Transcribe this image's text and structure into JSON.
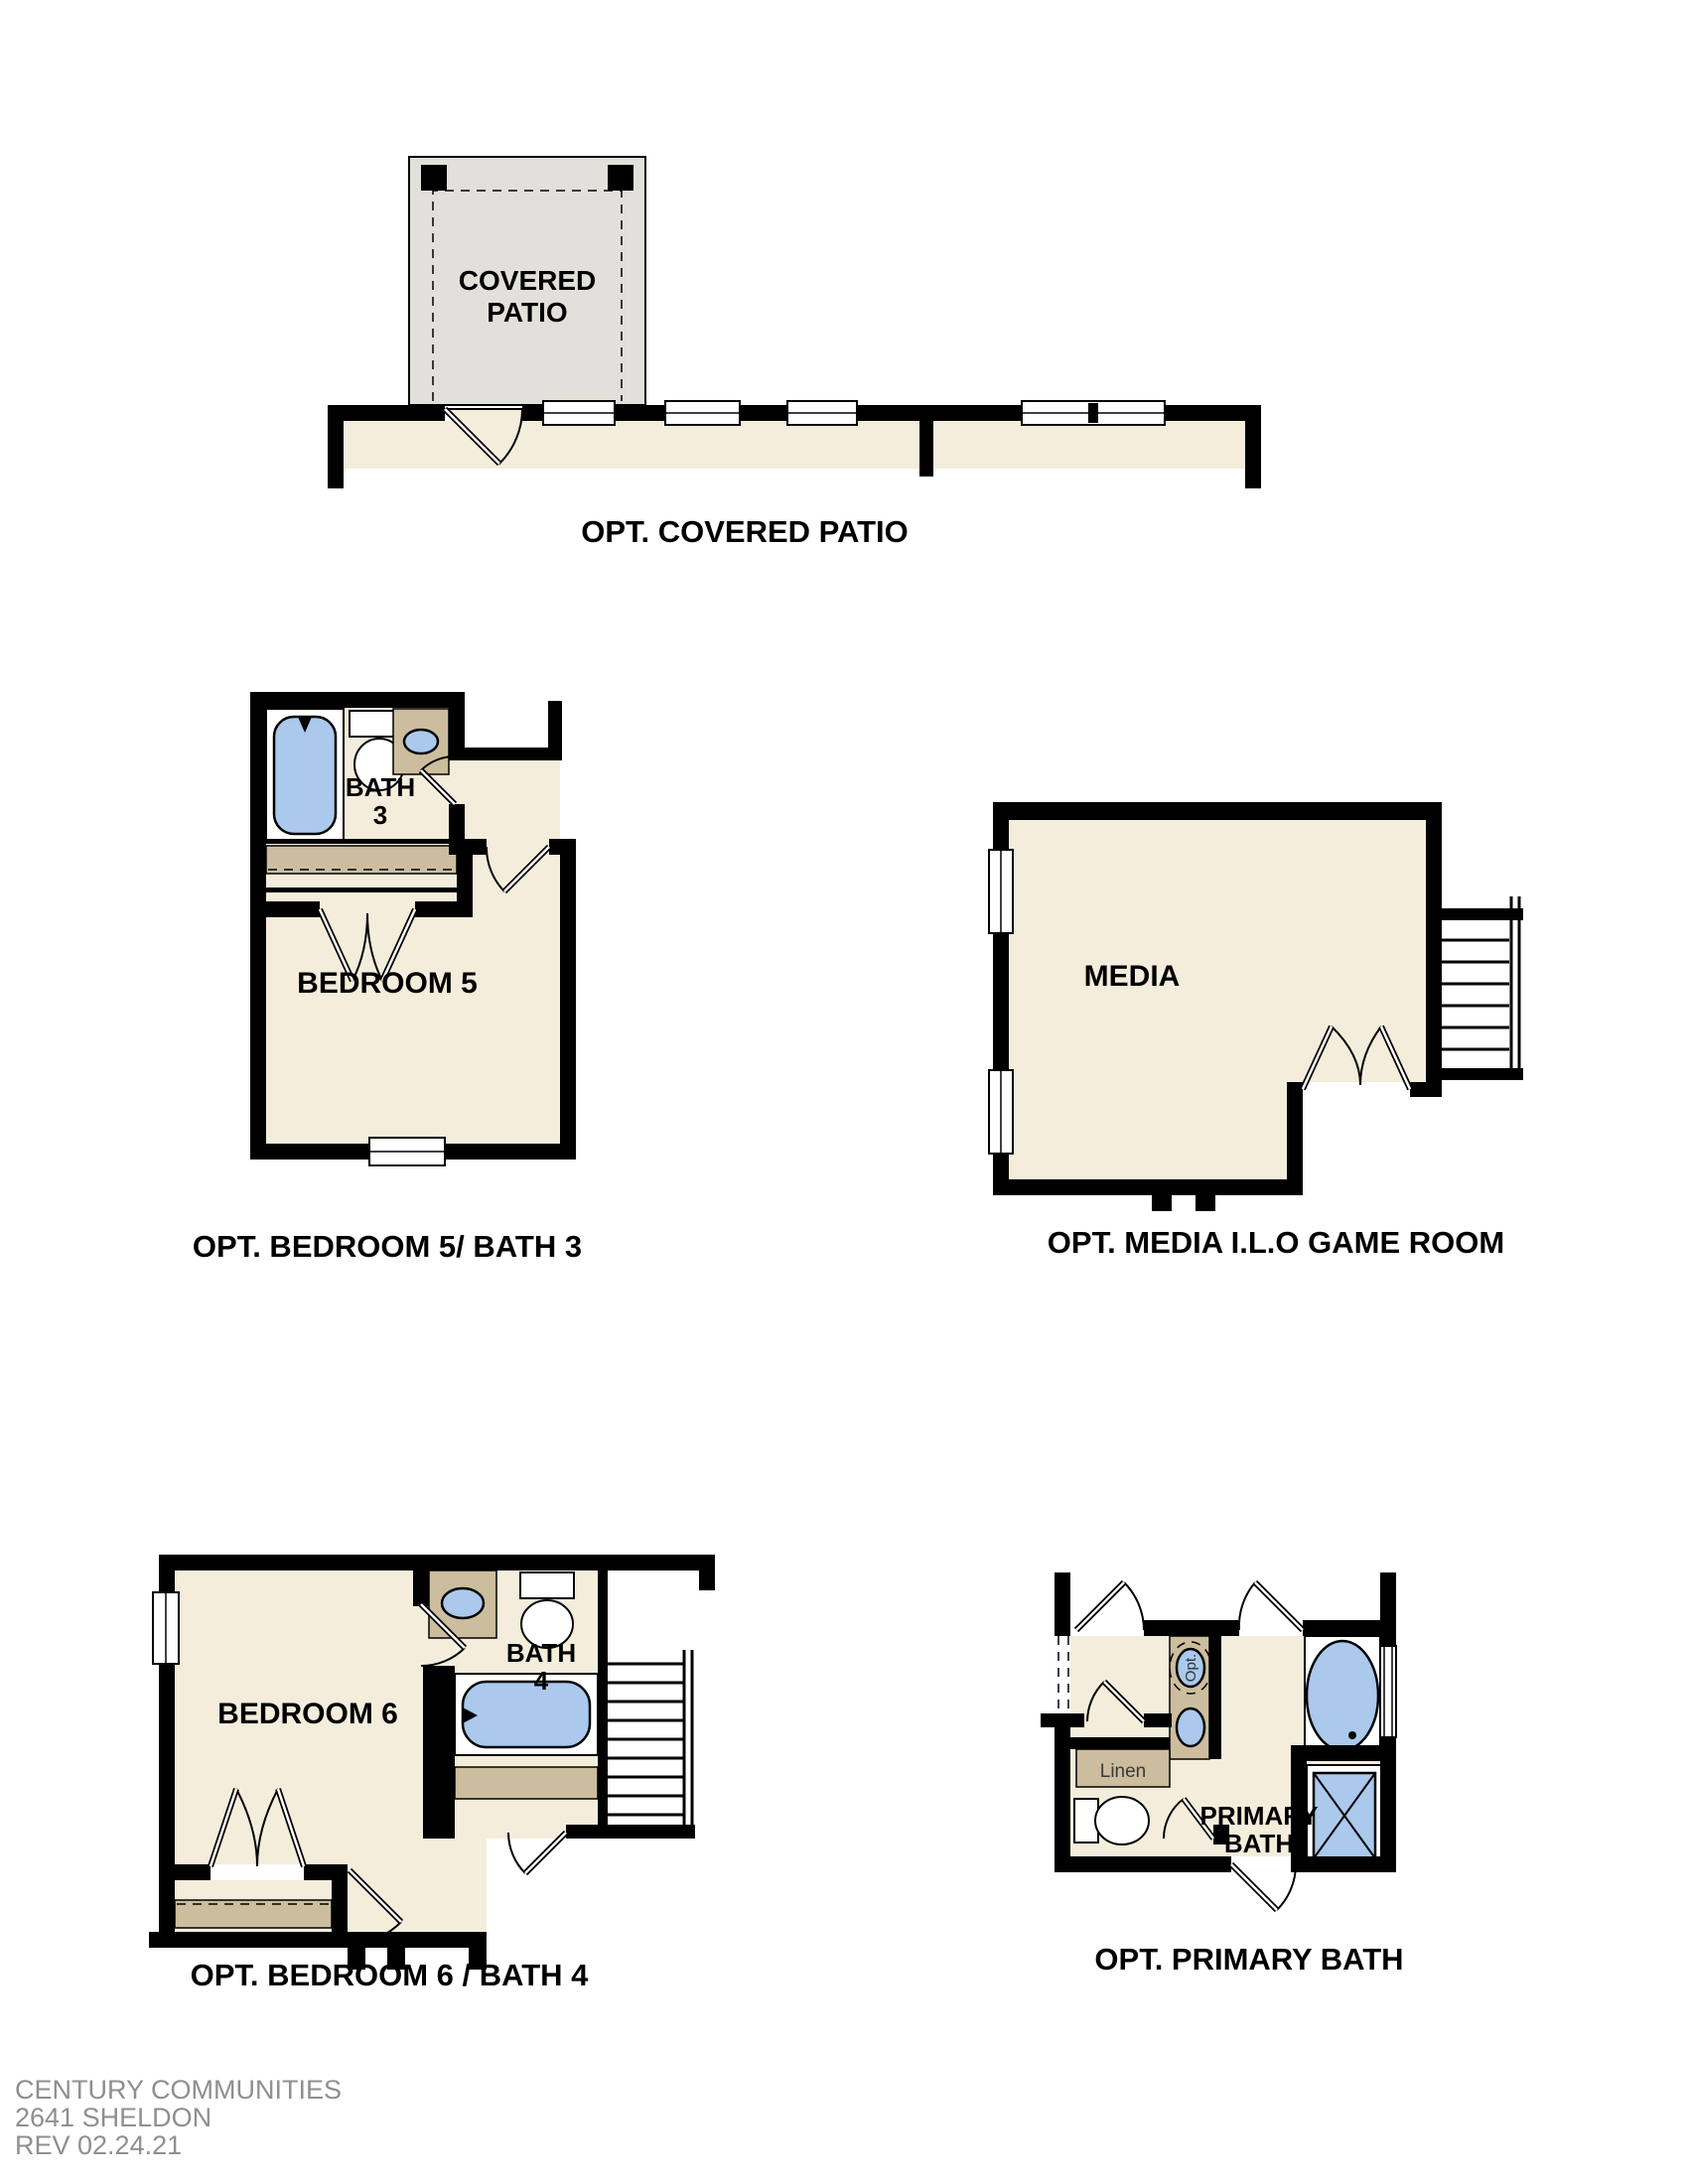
{
  "colors": {
    "floor": "#f4eddc",
    "patio": "#e2e0da",
    "tan": "#ccbd9e",
    "blue": "#aac9ec",
    "wall": "#000000",
    "gray": "#8f8f8f"
  },
  "plans": {
    "covered_patio": {
      "room_line1": "COVERED",
      "room_line2": "PATIO",
      "caption": "OPT. COVERED PATIO"
    },
    "bedroom5_bath3": {
      "bath_line1": "BATH",
      "bath_line2": "3",
      "room": "BEDROOM 5",
      "caption": "OPT. BEDROOM 5/ BATH 3"
    },
    "media": {
      "room": "MEDIA",
      "caption": "OPT. MEDIA I.L.O GAME ROOM"
    },
    "bedroom6_bath4": {
      "room": "BEDROOM 6",
      "bath_line1": "BATH",
      "bath_line2": "4",
      "caption": "OPT. BEDROOM 6 / BATH 4"
    },
    "primary_bath": {
      "opt_sink": "Opt.",
      "linen": "Linen",
      "room_line1": "PRIMARY",
      "room_line2": "BATH",
      "caption": "OPT. PRIMARY BATH"
    }
  },
  "title_block": {
    "line1": "CENTURY COMMUNITIES",
    "line2": "2641 SHELDON",
    "line3": "REV 02.24.21"
  }
}
